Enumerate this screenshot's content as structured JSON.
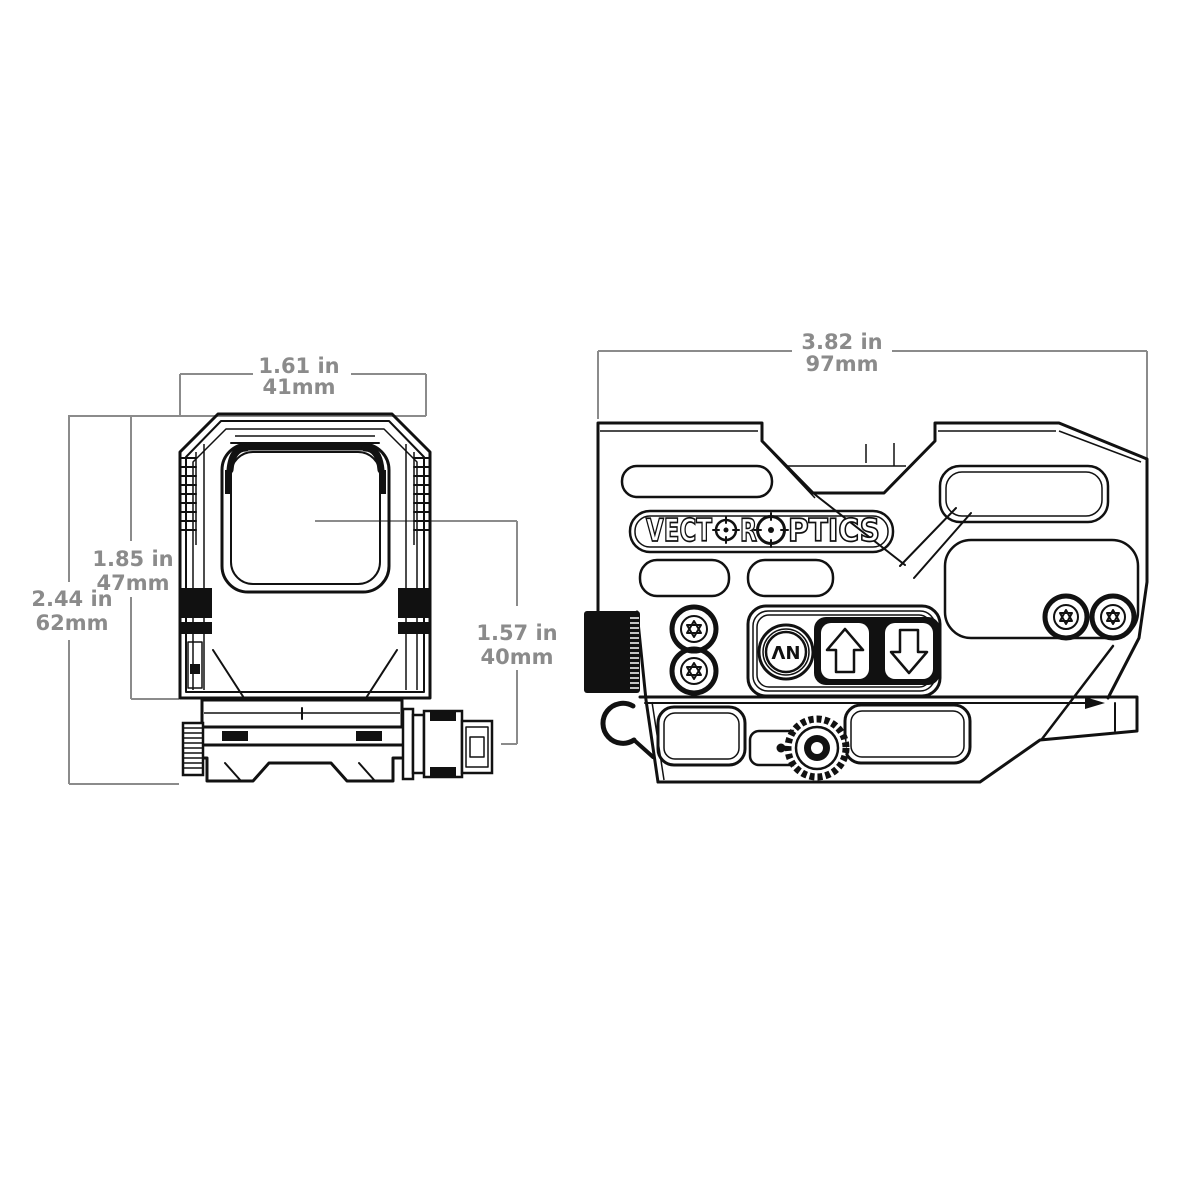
{
  "drawing": {
    "type": "technical-dimension-drawing",
    "product": "reflex red dot sight",
    "colors": {
      "line": "#111111",
      "dimension_gray": "#8b8b8b",
      "background": "#ffffff"
    },
    "brand_logo": {
      "text": "VECTOR OPTICS",
      "seg1": "VECT",
      "seg2": "R",
      "seg3": "PTICS"
    },
    "front_view": {
      "label": "front view",
      "dim_width_top": {
        "in": "1.61 in",
        "mm": "41mm"
      },
      "dim_height_body": {
        "in": "1.85 in",
        "mm": "47mm"
      },
      "dim_height_overall": {
        "in": "2.44 in",
        "mm": "62mm"
      },
      "dim_axis_height": {
        "in": "1.57 in",
        "mm": "40mm"
      }
    },
    "side_view": {
      "label": "side view",
      "dim_length_overall": {
        "in": "3.82 in",
        "mm": "97mm"
      },
      "controls": {
        "nv_button": "NV"
      }
    }
  }
}
